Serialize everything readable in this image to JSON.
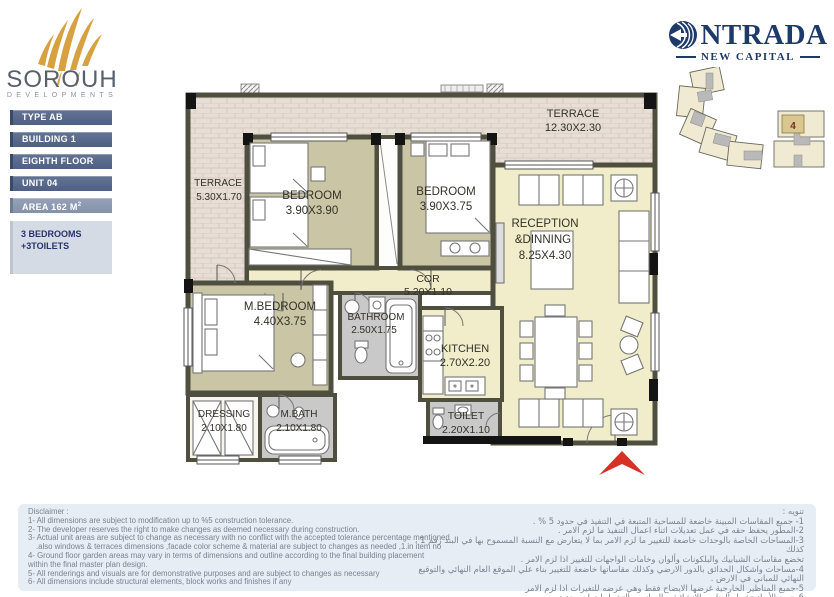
{
  "colors": {
    "gold": "#d8a13f",
    "navy": "#1e3a68",
    "badge_slate": "#4e6083",
    "badge_light": "#8492aa",
    "summary_bg": "#d5dbe4",
    "floor_khaki": "#cac6a5",
    "floor_pale": "#f1edca",
    "floor_gray": "#c9c9c9",
    "terrace_stone": "#e7dfd6",
    "wall": "#4e4f3e",
    "arrow_red": "#d93025",
    "disclaimer_bg": "#e6edf4"
  },
  "brand": {
    "name": "SOROUH",
    "tagline": "DEVELOPMENTS"
  },
  "project": {
    "logo_text": "NTRADA",
    "subtitle": "NEW CAPITAL",
    "keyplan_unit": "4"
  },
  "unit_info": {
    "badges": [
      {
        "label": "TYPE AB"
      },
      {
        "label": "BUILDING 1"
      },
      {
        "label": "EIGHTH FLOOR"
      },
      {
        "label": "UNIT 04"
      },
      {
        "label": "AREA 162 M",
        "sup": "2"
      }
    ],
    "summary_line1": "3 BEDROOMS",
    "summary_line2": "+3TOILETS"
  },
  "plan": {
    "rooms": [
      {
        "name": "TERRACE",
        "dims": "5.30X1.70"
      },
      {
        "name": "BEDROOM",
        "dims": "3.90X3.90"
      },
      {
        "name": "BEDROOM",
        "dims": "3.90X3.75"
      },
      {
        "name": "TERRACE",
        "dims": "12.30X2.30"
      },
      {
        "name": "RECEPTION",
        "name2": "&DINNING",
        "dims": "8.25X4.30"
      },
      {
        "name": "COR",
        "dims": "5.20X1.10"
      },
      {
        "name": "M.BEDROOM",
        "dims": "4.40X3.75"
      },
      {
        "name": "BATHROOM",
        "dims": "2.50X1.75"
      },
      {
        "name": "KITCHEN",
        "dims": "2.70X2.20"
      },
      {
        "name": "DRESSING",
        "dims": "2.10X1.80"
      },
      {
        "name": "M.BATH",
        "dims": "2.10X1.80"
      },
      {
        "name": "TOILET",
        "dims": "2.20X1.10"
      }
    ]
  },
  "disclaimer": {
    "title_en": "Disclaimer :",
    "lines_en": [
      "1- All dimensions are subject  to modification up to %5 construction tolerance.",
      "2- The developer reserves the right to make changes as deemed necessary during construction.",
      "3- Actual unit areas are subject to change as necessary with no conflict with the accepted tolerance percentage mentioned",
      ".also windows & terraces dimensions ,facade color scheme & material are subject to changes as needed ,1.in item no",
      "4- Ground floor garden areas may vary in terms of dimensions and outline according to the final building placement",
      "within the final master plan design.",
      "5- All renderings and visuals are for demonstrative purposes and are subject to changes as necessary",
      "6- All dimensions include structural elements, block works and finishes if any"
    ],
    "title_ar": "تنويه :",
    "lines_ar": [
      "1- جميع المقاسات المبينة خاضعة للمساحية المتبعة في التنفيذ في حدود 5 % .",
      "2-المطور يحفظ حقه في عمل تعديلات اثناء اعمال التنفيذ ما لزم الامر .",
      "3-المساحات الخاصة بالوحدات خاضعة للتغيير ما لزم الامر بما لا يتعارض مع النسبة المسموح بها في البند رقم 1 ، كذلك",
      "تخضع مقاسات الشبابيك والبلكونات وألوان وخامات الواجهات للتغيير اذا لزم الامر .",
      "4-مساحات واشكال الحدائق بالدور الارضي وكذلك مقاساتها خاضعة للتغيير بناء علي الموقع العام النهائي والتوقيع",
      "النهائي للمباني في الارض .",
      "5-جميع المناظير الخارجية غرضها الايضاح فقط وهي عرضه للتغيرات اذا لزم الامر",
      "6-جميع الأبعاد تشمل العناصر الإنشائية و المباني و التشطيبات إن وجدت"
    ]
  }
}
